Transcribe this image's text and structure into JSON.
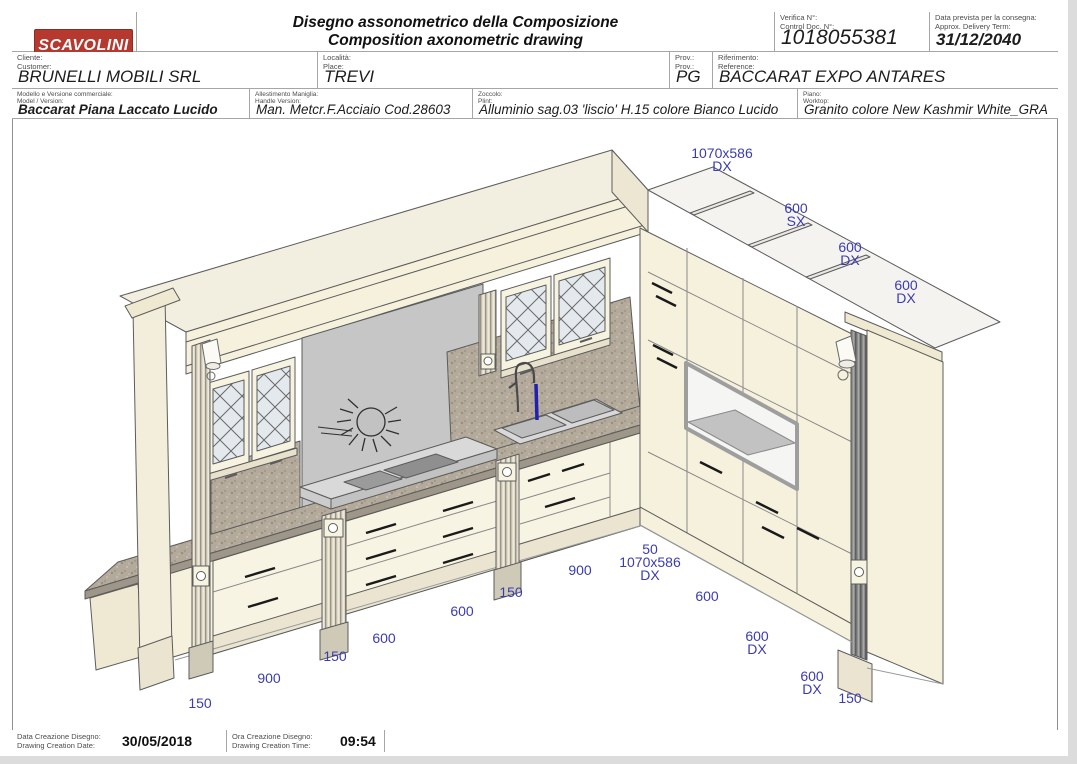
{
  "header": {
    "logo": "SCAVOLINI",
    "title_line1": "Disegno assonometrico della Composizione",
    "title_line2": "Composition axonometric drawing",
    "control_doc": {
      "label1": "Verifica N°:",
      "label2": "Control Doc. N°:",
      "value": "1018055381"
    },
    "delivery": {
      "label1": "Data prevista per la consegna:",
      "label2": "Approx. Delivery Term:",
      "value": "31/12/2040"
    },
    "customer": {
      "label1": "Cliente:",
      "label2": "Customer:",
      "value": "BRUNELLI MOBILI SRL"
    },
    "place": {
      "label1": "Località:",
      "label2": "Place:",
      "value": "TREVI"
    },
    "prov": {
      "label1": "Prov.:",
      "label2": "Prov.:",
      "value": "PG"
    },
    "reference": {
      "label1": "Riferimento:",
      "label2": "Reference:",
      "value": "BACCARAT EXPO ANTARES"
    },
    "model": {
      "label1": "Modello e Versione commerciale:",
      "label2": "Model / Version:",
      "value": "Baccarat Piana Laccato Lucido"
    },
    "handle": {
      "label1": "Allestimento Maniglia:",
      "label2": "Handle Version:",
      "value": "Man. Metcr.F.Acciaio Cod.28603"
    },
    "plinth": {
      "label1": "Zoccolo:",
      "label2": "Plint:",
      "value": "Alluminio sag.03 'liscio' H.15 colore Bianco Lucido"
    },
    "worktop": {
      "label1": "Piano:",
      "label2": "Worktop:",
      "value": "Granito colore New Kashmir White_GRA"
    }
  },
  "footer": {
    "date": {
      "label1": "Data Creazione Disegno:",
      "label2": "Drawing Creation Date:",
      "value": "30/05/2018"
    },
    "time": {
      "label1": "Ora Creazione Disegno:",
      "label2": "Drawing Creation Time:",
      "value": "09:54"
    }
  },
  "drawing": {
    "dimension_color": "#3c3cae",
    "dimensions": [
      {
        "x": 722,
        "y": 158,
        "lines": [
          "1070x586",
          "DX"
        ]
      },
      {
        "x": 796,
        "y": 213,
        "lines": [
          "600",
          "SX"
        ]
      },
      {
        "x": 850,
        "y": 252,
        "lines": [
          "600",
          "DX"
        ]
      },
      {
        "x": 906,
        "y": 290,
        "lines": [
          "600",
          "DX"
        ]
      },
      {
        "x": 200,
        "y": 708,
        "lines": [
          "150"
        ]
      },
      {
        "x": 269,
        "y": 683,
        "lines": [
          "900"
        ]
      },
      {
        "x": 335,
        "y": 661,
        "lines": [
          "150"
        ]
      },
      {
        "x": 384,
        "y": 643,
        "lines": [
          "600"
        ]
      },
      {
        "x": 462,
        "y": 616,
        "lines": [
          "600"
        ]
      },
      {
        "x": 511,
        "y": 597,
        "lines": [
          "150"
        ]
      },
      {
        "x": 580,
        "y": 575,
        "lines": [
          "900"
        ]
      },
      {
        "x": 650,
        "y": 554,
        "lines": [
          "50",
          "1070x586",
          "DX"
        ]
      },
      {
        "x": 707,
        "y": 601,
        "lines": [
          "600"
        ]
      },
      {
        "x": 757,
        "y": 641,
        "lines": [
          "600",
          "DX"
        ]
      },
      {
        "x": 812,
        "y": 681,
        "lines": [
          "600",
          "DX"
        ]
      },
      {
        "x": 850,
        "y": 703,
        "lines": [
          "150"
        ]
      }
    ]
  },
  "colors": {
    "logo_red": "#b5392e",
    "dimension_blue": "#3c3cae",
    "cream_panel": "#f6f1dd",
    "granite": "#b3aa9b",
    "backsplash_gray": "#c6c6c6",
    "water_blue": "#1f1fb0"
  }
}
